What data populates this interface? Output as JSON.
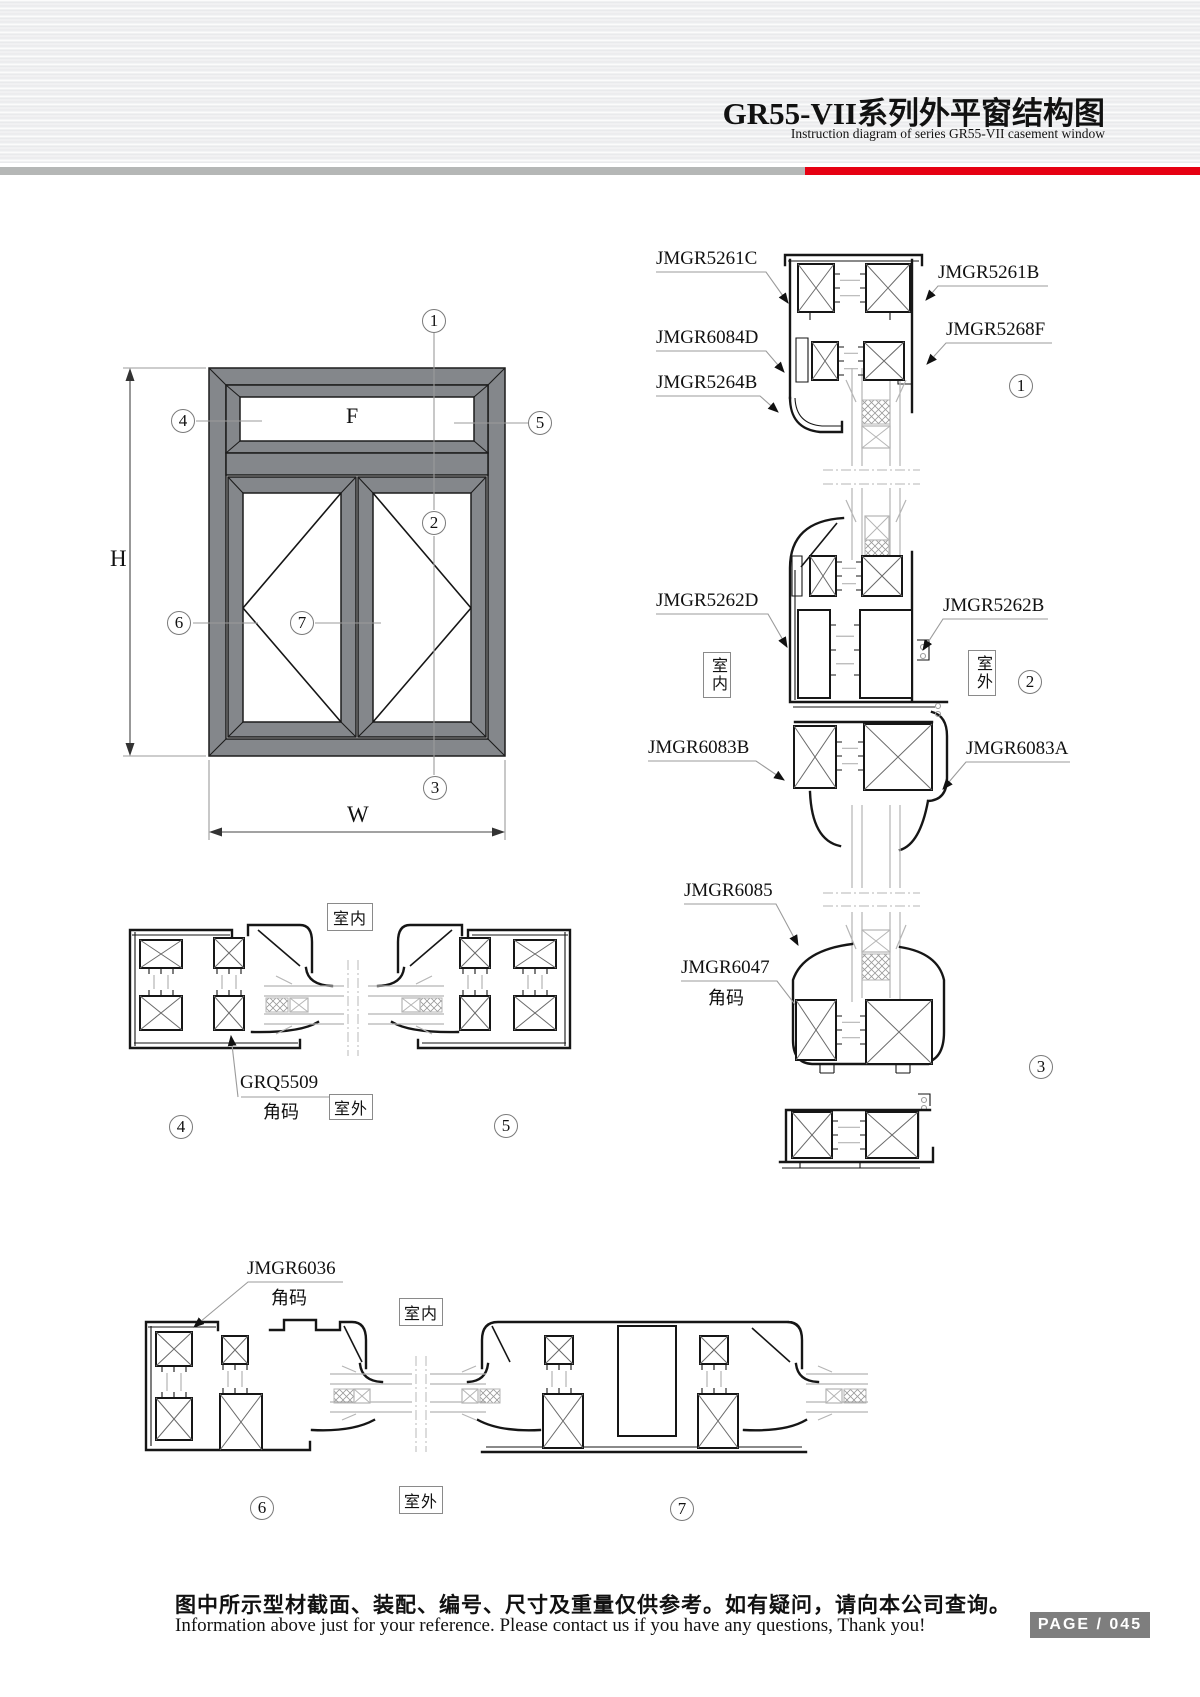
{
  "header": {
    "title": "GR55-VII系列外平窗结构图",
    "subtitle": "Instruction diagram of series GR55-VII casement window"
  },
  "elevation": {
    "panel_f": "F",
    "dim_h": "H",
    "dim_w": "W",
    "callouts": [
      "1",
      "2",
      "3",
      "4",
      "5",
      "6",
      "7"
    ]
  },
  "vertical_section": {
    "indoor": "室内",
    "outdoor": "室外",
    "callout_1": "1",
    "callout_2": "2",
    "callout_3": "3",
    "labels": {
      "jmgr5261c": "JMGR5261C",
      "jmgr5261b": "JMGR5261B",
      "jmgr6084d": "JMGR6084D",
      "jmgr5268f": "JMGR5268F",
      "jmgr5264b": "JMGR5264B",
      "jmgr5262d": "JMGR5262D",
      "jmgr5262b": "JMGR5262B",
      "jmgr6083b": "JMGR6083B",
      "jmgr6083a": "JMGR6083A",
      "jmgr6085": "JMGR6085",
      "jmgr6047": "JMGR6047",
      "jmgr6047_sub": "角码"
    }
  },
  "mid_section": {
    "part": "GRQ5509",
    "part_sub": "角码",
    "indoor": "室内",
    "outdoor": "室外",
    "callout_4": "4",
    "callout_5": "5"
  },
  "bottom_section": {
    "part": "JMGR6036",
    "part_sub": "角码",
    "indoor": "室内",
    "outdoor": "室外",
    "callout_6": "6",
    "callout_7": "7"
  },
  "footer": {
    "note_zh": "图中所示型材截面、装配、编号、尺寸及重量仅供参考。如有疑问，请向本公司查询。",
    "note_en": "Information above just for your reference. Please contact us if you have any questions, Thank you!",
    "page_badge": "PAGE / 045"
  }
}
